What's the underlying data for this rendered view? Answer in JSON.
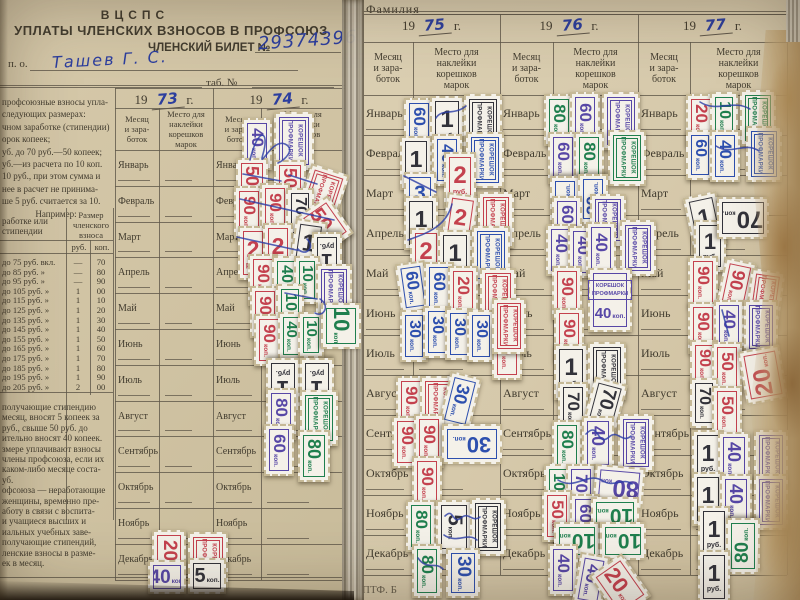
{
  "photo": {
    "left_page": {
      "org": "ВЦСПС",
      "title": "УПЛАТЫ ЧЛЕНСКИХ ВЗНОСОВ В ПРОФСОЮЗ",
      "ticket_label": "ЧЛЕНСКИЙ БИЛЕТ №",
      "ticket_number": "29374396",
      "po_label": "п. о.",
      "name_value": "Ташев Г. С.",
      "tab_label": "таб. №",
      "years": [
        "73",
        "74"
      ],
      "info_lines": [
        "профсоюзные взносы упла-",
        "следующих размерах:",
        "чном заработке (стипендии)",
        "орок копеек;",
        "уб. до 70 руб.—50 копеек;",
        "уб.—из расчета по 10 коп.",
        "10 руб., при этом сумма и",
        "нее в расчет не принима-",
        "ше 5 руб. считается за 10.",
        "Например:"
      ],
      "rate_table": {
        "col_label_header": "работке или\nстипендии",
        "col_size_header": "Размер\nчленского\nвзноса",
        "rub_header": "руб.",
        "kop_header": "коп.",
        "rows": [
          {
            "label": "до  75 руб. вкл.",
            "rub": "—",
            "kop": "70"
          },
          {
            "label": "до  85 руб.   »",
            "rub": "—",
            "kop": "80"
          },
          {
            "label": "до  95 руб.   »",
            "rub": "—",
            "kop": "90"
          },
          {
            "label": "до 105 руб.   »",
            "rub": "1",
            "kop": "00"
          },
          {
            "label": "до 115 руб.   »",
            "rub": "1",
            "kop": "10"
          },
          {
            "label": "до 125 руб.   »",
            "rub": "1",
            "kop": "20"
          },
          {
            "label": "до 135 руб.   »",
            "rub": "1",
            "kop": "30"
          },
          {
            "label": "до 145 руб.   »",
            "rub": "1",
            "kop": "40"
          },
          {
            "label": "до 155 руб.   »",
            "rub": "1",
            "kop": "50"
          },
          {
            "label": "до 165 руб.   »",
            "rub": "1",
            "kop": "60"
          },
          {
            "label": "до 175 руб.   »",
            "rub": "1",
            "kop": "70"
          },
          {
            "label": "до 185 руб.   »",
            "rub": "1",
            "kop": "80"
          },
          {
            "label": "до 195 руб.   »",
            "rub": "1",
            "kop": "90"
          },
          {
            "label": "до 205 руб.   »",
            "rub": "2",
            "kop": "00"
          }
        ]
      },
      "notes_lines": [
        "получающие стипендию",
        "месяц, вносят 5 копеек за",
        "руб., свыше 50 руб. до",
        "ительно вносят 40 копеек.",
        "змере уплачивают взносы",
        "члены профсоюза, если их",
        "каком-либо месяце соста-",
        "уб.",
        "офсоюза — неработающие",
        "женщины, временно пре-",
        "аботу в связи с воспита-",
        "и учащиеся высших и",
        "иальных учебных заве-",
        "получающие стипендий,",
        "ленские взносы в разме-",
        "ек в месяц."
      ]
    },
    "right_page": {
      "surname_label": "Фамилия",
      "years": [
        "75",
        "76",
        "77"
      ],
      "footer_note": "ПТФ. Б"
    },
    "year_prefix": "19",
    "year_suffix": "г.",
    "month_col_header": "Месяц\nи зара-\nботок",
    "place_col_header": "Место для\nнаклейки\nкорешков\nмарок",
    "months": [
      "Январь",
      "Февраль",
      "Март",
      "Апрель",
      "Май",
      "Июнь",
      "Июль",
      "Август",
      "Сентябрь",
      "Октябрь",
      "Ноябрь",
      "Декабрь"
    ]
  },
  "stamps": {
    "stub_line1": "КОРЕШОК",
    "stub_line2": "ПРОФМАРКИ",
    "unit_kop": "коп.",
    "unit_rub": "руб.",
    "items": [
      [
        "k",
        242,
        118,
        30,
        52,
        "pu",
        "40",
        0
      ],
      [
        "s",
        274,
        112,
        40,
        58,
        "pu",
        "",
        0
      ],
      [
        "k",
        236,
        158,
        32,
        50,
        "rd",
        "50",
        0
      ],
      [
        "k",
        274,
        160,
        32,
        50,
        "rd",
        "50",
        0
      ],
      [
        "s",
        302,
        168,
        40,
        56,
        "rd",
        "",
        18
      ],
      [
        "k",
        234,
        186,
        30,
        52,
        "rd",
        "90",
        0
      ],
      [
        "k",
        260,
        183,
        30,
        52,
        "rd",
        "90",
        0
      ],
      [
        "k",
        286,
        188,
        28,
        50,
        "bk",
        "70",
        0
      ],
      [
        "k",
        306,
        202,
        38,
        46,
        "rd",
        "50",
        -35
      ],
      [
        "R",
        238,
        226,
        30,
        54,
        "rd",
        "2",
        0
      ],
      [
        "R",
        263,
        223,
        30,
        54,
        "rd",
        "2",
        0
      ],
      [
        "R",
        292,
        220,
        32,
        56,
        "bk",
        "1",
        8
      ],
      [
        "R",
        312,
        232,
        30,
        50,
        "bk",
        "1",
        180
      ],
      [
        "k",
        248,
        254,
        30,
        52,
        "rd",
        "90",
        0
      ],
      [
        "k",
        272,
        256,
        28,
        50,
        "gn",
        "40",
        0
      ],
      [
        "k",
        294,
        256,
        26,
        48,
        "gn",
        "10",
        0
      ],
      [
        "s",
        316,
        264,
        36,
        54,
        "pu",
        "",
        0
      ],
      [
        "k",
        250,
        286,
        30,
        52,
        "rd",
        "90",
        0
      ],
      [
        "k",
        276,
        284,
        28,
        50,
        "gn",
        "10",
        0
      ],
      [
        "k",
        254,
        314,
        30,
        52,
        "rd",
        "90",
        0
      ],
      [
        "k",
        278,
        312,
        26,
        48,
        "gn",
        "40",
        0
      ],
      [
        "k",
        298,
        312,
        26,
        46,
        "gn",
        "10",
        0
      ],
      [
        "k",
        318,
        306,
        46,
        40,
        "gn",
        "10",
        90
      ],
      [
        "R",
        266,
        358,
        34,
        54,
        "bk",
        "1",
        180
      ],
      [
        "R",
        300,
        358,
        34,
        54,
        "bk",
        "1",
        180
      ],
      [
        "k",
        266,
        388,
        30,
        52,
        "pu",
        "80",
        0
      ],
      [
        "s",
        300,
        390,
        38,
        56,
        "gn",
        "",
        0
      ],
      [
        "k",
        264,
        424,
        30,
        52,
        "pu",
        "60",
        0
      ],
      [
        "k",
        298,
        430,
        32,
        52,
        "gn",
        "80",
        0
      ],
      [
        "k",
        152,
        530,
        34,
        54,
        "rd",
        "20",
        0
      ],
      [
        "s",
        188,
        532,
        40,
        56,
        "rd",
        "",
        0
      ],
      [
        "k",
        148,
        560,
        38,
        34,
        "pu",
        "40",
        0
      ],
      [
        "k",
        188,
        558,
        38,
        36,
        "bk",
        "5",
        0
      ],
      [
        "k",
        404,
        98,
        30,
        50,
        "bl",
        "60",
        0
      ],
      [
        "R",
        430,
        96,
        34,
        56,
        "bk",
        "1",
        0
      ],
      [
        "s",
        464,
        94,
        38,
        58,
        "bk",
        "",
        0
      ],
      [
        "R",
        400,
        136,
        32,
        54,
        "bk",
        "1",
        0
      ],
      [
        "k",
        432,
        134,
        30,
        52,
        "bl",
        "40",
        0
      ],
      [
        "s",
        466,
        132,
        38,
        56,
        "bl",
        "",
        0
      ],
      [
        "R",
        444,
        152,
        32,
        56,
        "rd",
        "2",
        0
      ],
      [
        "R",
        404,
        172,
        32,
        50,
        "bl",
        "3",
        0
      ],
      [
        "R",
        404,
        196,
        34,
        54,
        "bk",
        "1",
        0
      ],
      [
        "R",
        444,
        194,
        32,
        54,
        "rd",
        "2",
        8
      ],
      [
        "s",
        478,
        192,
        36,
        56,
        "rd",
        "",
        0
      ],
      [
        "R",
        410,
        228,
        32,
        56,
        "rd",
        "2",
        0
      ],
      [
        "R",
        438,
        230,
        34,
        56,
        "bk",
        "1",
        0
      ],
      [
        "s",
        472,
        226,
        38,
        58,
        "bl",
        "",
        0
      ],
      [
        "k",
        398,
        262,
        30,
        50,
        "bl",
        "60",
        -8
      ],
      [
        "k",
        424,
        262,
        30,
        52,
        "bl",
        "60",
        0
      ],
      [
        "k",
        448,
        266,
        30,
        52,
        "rd",
        "20",
        0
      ],
      [
        "s",
        480,
        268,
        36,
        56,
        "rd",
        "",
        0
      ],
      [
        "k",
        400,
        310,
        28,
        52,
        "bl",
        "30",
        0
      ],
      [
        "k",
        423,
        306,
        28,
        52,
        "bl",
        "30",
        0
      ],
      [
        "k",
        445,
        308,
        28,
        52,
        "bl",
        "30",
        0
      ],
      [
        "k",
        467,
        310,
        28,
        52,
        "bl",
        "30",
        0
      ],
      [
        "k",
        492,
        324,
        30,
        56,
        "rd",
        "20",
        0
      ],
      [
        "k",
        396,
        376,
        30,
        52,
        "rd",
        "90",
        0
      ],
      [
        "s",
        420,
        376,
        38,
        56,
        "rd",
        "",
        0
      ],
      [
        "k",
        444,
        374,
        32,
        54,
        "bl",
        "30",
        14
      ],
      [
        "k",
        392,
        416,
        30,
        52,
        "rd",
        "90",
        0
      ],
      [
        "k",
        414,
        414,
        30,
        54,
        "rd",
        "90",
        0
      ],
      [
        "k",
        452,
        414,
        40,
        60,
        "bl",
        "30",
        90
      ],
      [
        "k",
        412,
        456,
        30,
        54,
        "rd",
        "90",
        0
      ],
      [
        "k",
        406,
        500,
        30,
        52,
        "gn",
        "80",
        0
      ],
      [
        "k",
        436,
        500,
        36,
        54,
        "bk",
        "5",
        0
      ],
      [
        "s",
        470,
        498,
        36,
        58,
        "bk",
        "",
        0
      ],
      [
        "k",
        412,
        544,
        30,
        54,
        "gn",
        "80",
        0
      ],
      [
        "k",
        446,
        548,
        34,
        50,
        "bl",
        "30",
        0
      ],
      [
        "k",
        544,
        94,
        30,
        52,
        "gn",
        "80",
        0
      ],
      [
        "k",
        570,
        92,
        30,
        54,
        "pu",
        "60",
        0
      ],
      [
        "s",
        602,
        92,
        38,
        58,
        "pu",
        "",
        0
      ],
      [
        "k",
        548,
        132,
        30,
        52,
        "pu",
        "60",
        0
      ],
      [
        "k",
        574,
        132,
        30,
        52,
        "gn",
        "80",
        0
      ],
      [
        "s",
        608,
        130,
        38,
        56,
        "gn",
        "",
        0
      ],
      [
        "k",
        550,
        176,
        30,
        50,
        "bl",
        "30",
        180
      ],
      [
        "k",
        578,
        174,
        30,
        50,
        "bl",
        "30",
        180
      ],
      [
        "k",
        552,
        196,
        30,
        50,
        "pu",
        "60",
        0
      ],
      [
        "s",
        590,
        194,
        36,
        52,
        "pu",
        "",
        0
      ],
      [
        "k",
        546,
        224,
        30,
        52,
        "pu",
        "40",
        0
      ],
      [
        "k",
        568,
        226,
        30,
        52,
        "pu",
        "40",
        0
      ],
      [
        "k",
        586,
        222,
        30,
        54,
        "pu",
        "40",
        0
      ],
      [
        "s",
        620,
        220,
        36,
        56,
        "pu",
        "",
        0
      ],
      [
        "k",
        552,
        266,
        30,
        54,
        "rd",
        "90",
        0
      ],
      [
        "c",
        588,
        268,
        44,
        64,
        "pu",
        "40",
        0
      ],
      [
        "k",
        554,
        308,
        30,
        54,
        "rd",
        "90",
        0
      ],
      [
        "s",
        492,
        298,
        34,
        56,
        "rd",
        "",
        0
      ],
      [
        "R",
        554,
        344,
        34,
        56,
        "bk",
        "1",
        0
      ],
      [
        "s",
        588,
        342,
        38,
        58,
        "bk",
        "",
        0
      ],
      [
        "k",
        558,
        382,
        30,
        52,
        "bk",
        "70",
        0
      ],
      [
        "k",
        588,
        380,
        34,
        50,
        "bk",
        "70",
        15
      ],
      [
        "k",
        552,
        420,
        30,
        52,
        "gn",
        "80",
        0
      ],
      [
        "k",
        582,
        416,
        32,
        54,
        "pu",
        "40",
        0
      ],
      [
        "s",
        618,
        414,
        36,
        58,
        "pu",
        "",
        0
      ],
      [
        "k",
        544,
        464,
        28,
        50,
        "gn",
        "10",
        0
      ],
      [
        "k",
        566,
        464,
        30,
        52,
        "pu",
        "70",
        0
      ],
      [
        "k",
        598,
        462,
        42,
        50,
        "pu",
        "80",
        95
      ],
      [
        "k",
        542,
        490,
        30,
        52,
        "rd",
        "50",
        0
      ],
      [
        "k",
        570,
        494,
        30,
        52,
        "pu",
        "60",
        0
      ],
      [
        "k",
        596,
        492,
        38,
        48,
        "gn",
        "10",
        90
      ],
      [
        "k",
        558,
        518,
        38,
        46,
        "gn",
        "10",
        90
      ],
      [
        "k",
        604,
        518,
        38,
        46,
        "gn",
        "10",
        90
      ],
      [
        "k",
        548,
        544,
        30,
        52,
        "pu",
        "40",
        0
      ],
      [
        "k",
        576,
        554,
        30,
        52,
        "pu",
        "40",
        10
      ],
      [
        "k",
        600,
        560,
        40,
        52,
        "rd",
        "20",
        -35
      ],
      [
        "k",
        686,
        94,
        30,
        52,
        "rd",
        "20",
        0
      ],
      [
        "k",
        710,
        92,
        28,
        50,
        "gn",
        "10",
        0
      ],
      [
        "s",
        740,
        90,
        36,
        56,
        "gn",
        "",
        0
      ],
      [
        "k",
        686,
        130,
        28,
        50,
        "bl",
        "60",
        0
      ],
      [
        "k",
        710,
        130,
        30,
        52,
        "bl",
        "40",
        0
      ],
      [
        "s",
        746,
        126,
        36,
        56,
        "bl",
        "",
        0
      ],
      [
        "R",
        688,
        194,
        34,
        54,
        "bk",
        "1",
        -12
      ],
      [
        "R",
        694,
        220,
        32,
        52,
        "bk",
        "1",
        0
      ],
      [
        "k",
        722,
        192,
        42,
        52,
        "bk",
        "70",
        90
      ],
      [
        "k",
        688,
        256,
        30,
        52,
        "rd",
        "90",
        0
      ],
      [
        "k",
        720,
        260,
        32,
        54,
        "rd",
        "90",
        12
      ],
      [
        "s",
        748,
        270,
        34,
        54,
        "rd",
        "",
        8
      ],
      [
        "k",
        688,
        302,
        30,
        52,
        "rd",
        "90",
        0
      ],
      [
        "k",
        714,
        300,
        30,
        52,
        "pu",
        "40",
        0
      ],
      [
        "s",
        744,
        300,
        34,
        54,
        "pu",
        "",
        0
      ],
      [
        "k",
        690,
        340,
        28,
        50,
        "rd",
        "90",
        0
      ],
      [
        "k",
        712,
        342,
        30,
        52,
        "rd",
        "50",
        0
      ],
      [
        "k",
        742,
        348,
        42,
        54,
        "rd",
        "20",
        170
      ],
      [
        "k",
        690,
        378,
        28,
        50,
        "bk",
        "70",
        0
      ],
      [
        "k",
        712,
        386,
        30,
        52,
        "rd",
        "50",
        0
      ],
      [
        "R",
        692,
        430,
        32,
        54,
        "bk",
        "1",
        0
      ],
      [
        "k",
        718,
        432,
        32,
        54,
        "pu",
        "40",
        0
      ],
      [
        "s",
        754,
        430,
        34,
        56,
        "pu",
        "",
        0
      ],
      [
        "R",
        692,
        472,
        32,
        54,
        "bk",
        "1",
        0
      ],
      [
        "k",
        720,
        474,
        32,
        54,
        "pu",
        "40",
        0
      ],
      [
        "s",
        754,
        474,
        34,
        56,
        "pu",
        "",
        0
      ],
      [
        "R",
        698,
        506,
        32,
        54,
        "bk",
        "1",
        0
      ],
      [
        "k",
        726,
        518,
        34,
        56,
        "gn",
        "80",
        180
      ],
      [
        "R",
        698,
        550,
        32,
        54,
        "bk",
        "1",
        0
      ]
    ]
  },
  "colors": {
    "paper_left": "#d1c4a5",
    "paper_right": "#d8cbad",
    "line": "#5f574a",
    "print": "#423c2f",
    "ink_blue": "#2c3e9e",
    "stamp_white": "#f4f1e9",
    "stamp_red": "#c4414e",
    "stamp_green": "#1f7f4e",
    "stamp_purple": "#5747a6",
    "stamp_blue": "#2d4fae",
    "stamp_black": "#32323a"
  }
}
